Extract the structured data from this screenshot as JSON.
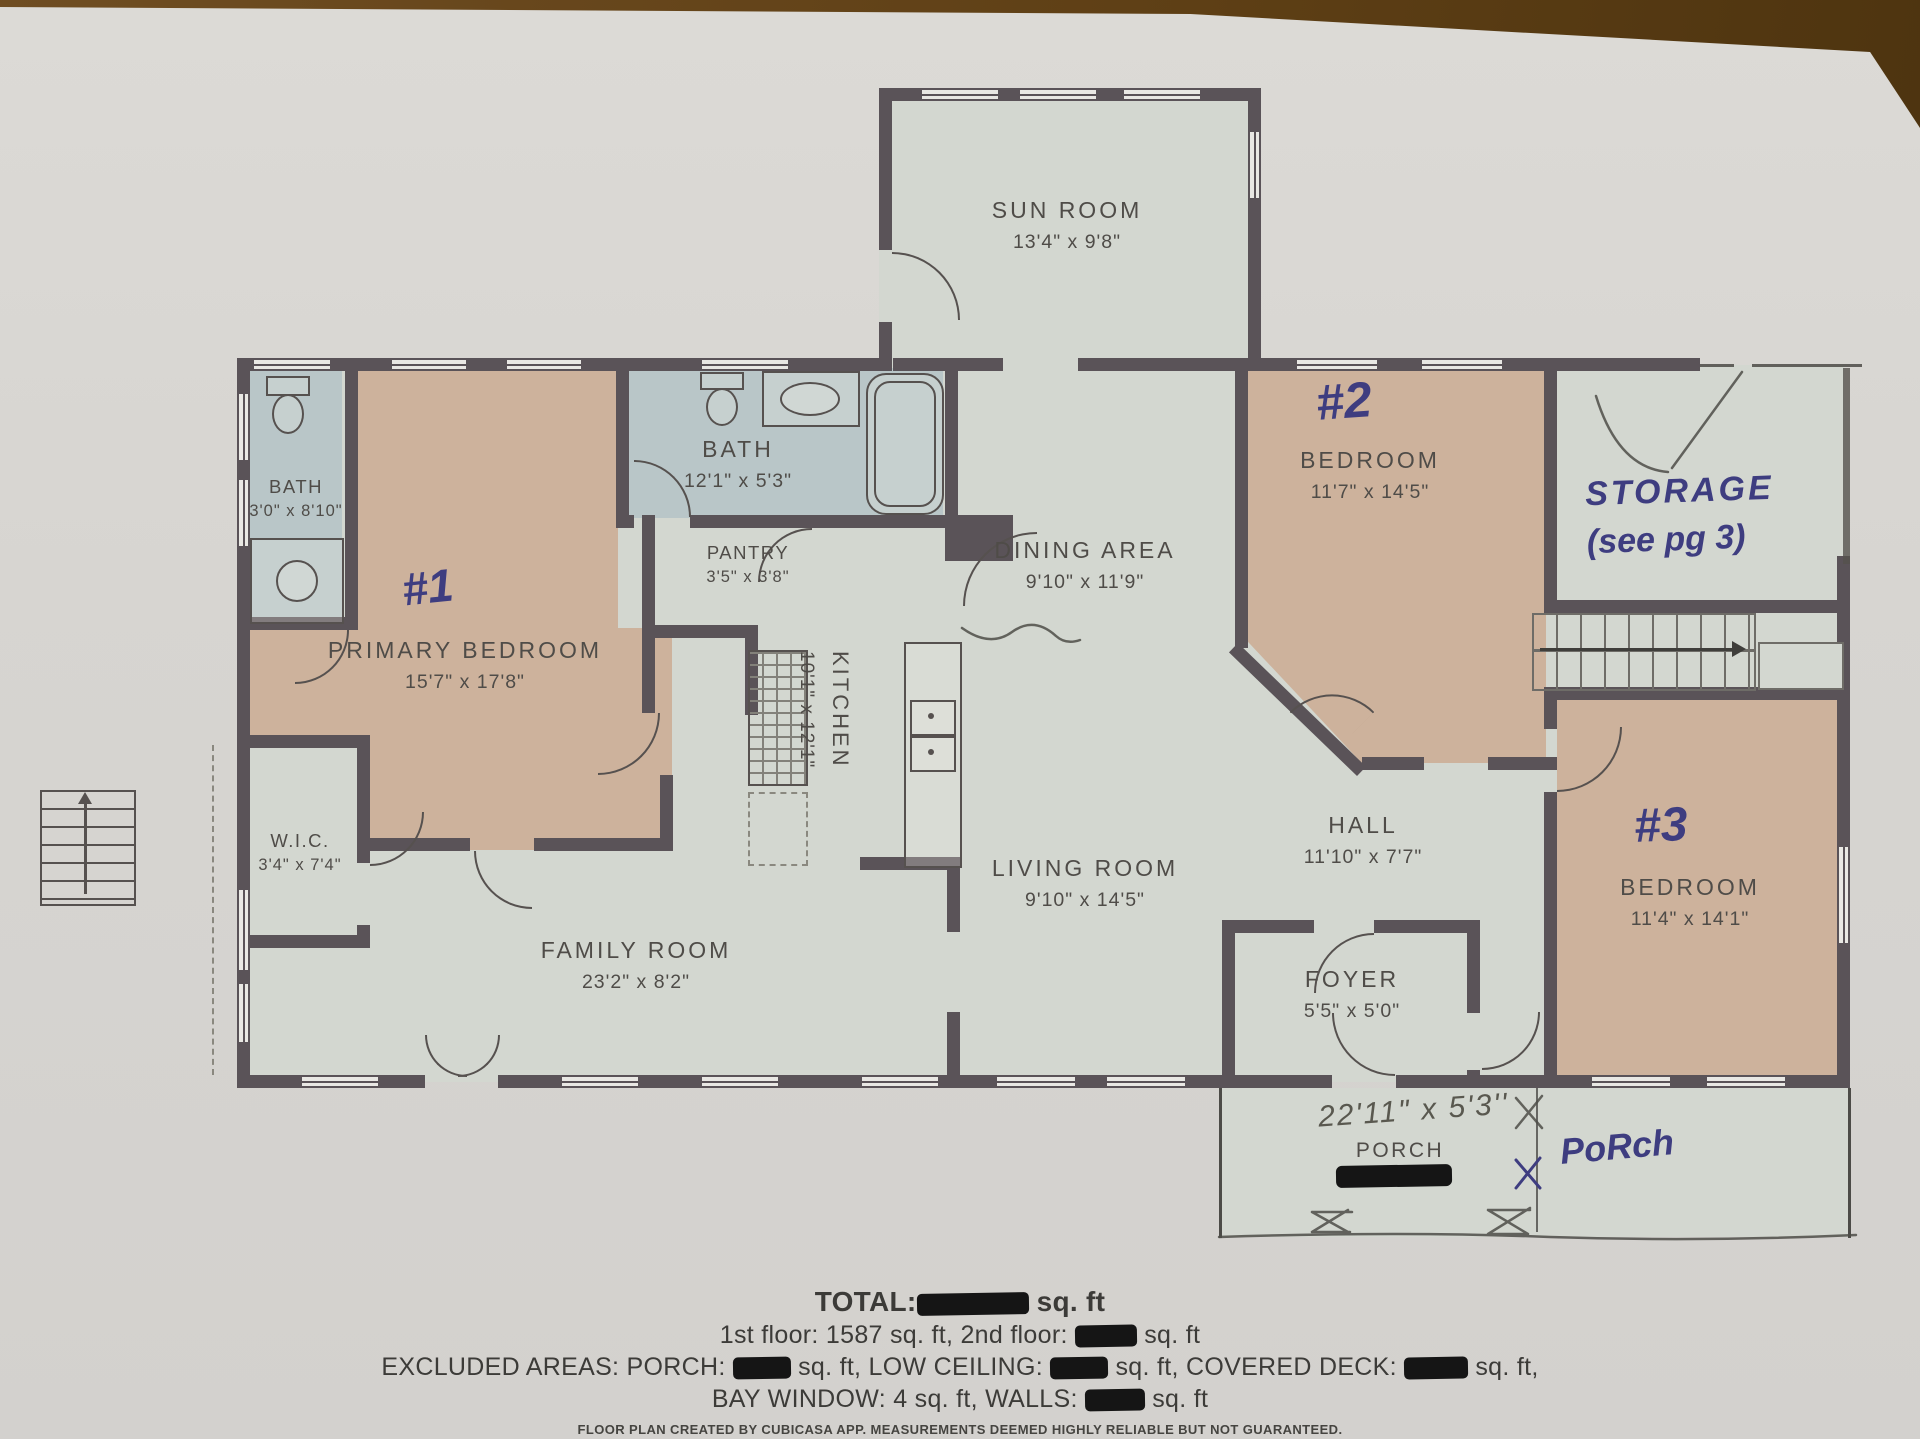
{
  "rooms": [
    {
      "id": "sun-room",
      "name": "SUN ROOM",
      "dims": "13'4\" x 9'8\""
    },
    {
      "id": "bath-upper",
      "name": "BATH",
      "dims": "12'1\" x 5'3\""
    },
    {
      "id": "bath-left",
      "name": "BATH",
      "dims": "3'0\" x 8'10\""
    },
    {
      "id": "pantry",
      "name": "PANTRY",
      "dims": "3'5\" x 3'8\""
    },
    {
      "id": "primary-bedroom",
      "name": "PRIMARY BEDROOM",
      "dims": "15'7\" x 17'8\"",
      "hand_number": "#1"
    },
    {
      "id": "kitchen",
      "name": "KITCHEN",
      "dims": "10'1\" x 12'1\""
    },
    {
      "id": "dining-area",
      "name": "DINING AREA",
      "dims": "9'10\" x 11'9\""
    },
    {
      "id": "bedroom-2",
      "name": "BEDROOM",
      "dims": "11'7\" x 14'5\"",
      "hand_number": "#2"
    },
    {
      "id": "wic",
      "name": "W.I.C.",
      "dims": "3'4\" x 7'4\""
    },
    {
      "id": "hall",
      "name": "HALL",
      "dims": "11'10\" x 7'7\""
    },
    {
      "id": "living-room",
      "name": "LIVING ROOM",
      "dims": "9'10\" x 14'5\""
    },
    {
      "id": "family-room",
      "name": "FAMILY ROOM",
      "dims": "23'2\" x 8'2\""
    },
    {
      "id": "bedroom-3",
      "name": "BEDROOM",
      "dims": "11'4\" x 14'1\"",
      "hand_number": "#3"
    },
    {
      "id": "foyer",
      "name": "FOYER",
      "dims": "5'5\" x 5'0\""
    },
    {
      "id": "porch",
      "name": "PORCH"
    }
  ],
  "handwritten": {
    "storage_line1": "STORAGE",
    "storage_line2": "(see pg 3)",
    "porch_label": "PoRch",
    "porch_dims": "22'11\" x 5'3''"
  },
  "summary": {
    "lines": [
      {
        "bold": true,
        "segments": [
          {
            "t": "TOTAL:"
          },
          {
            "redact": 112
          },
          {
            "t": " sq. ft"
          }
        ]
      },
      {
        "bold": false,
        "segments": [
          {
            "t": "1st floor: 1587 sq. ft, 2nd floor: "
          },
          {
            "redact": 62
          },
          {
            "t": " sq. ft"
          }
        ]
      },
      {
        "bold": false,
        "segments": [
          {
            "t": "EXCLUDED AREAS: PORCH: "
          },
          {
            "redact": 58
          },
          {
            "t": " sq. ft, LOW CEILING: "
          },
          {
            "redact": 58
          },
          {
            "t": " sq. ft, COVERED DECK: "
          },
          {
            "redact": 64
          },
          {
            "t": " sq. ft,"
          }
        ]
      },
      {
        "bold": false,
        "segments": [
          {
            "t": "BAY WINDOW: 4 sq. ft, WALLS: "
          },
          {
            "redact": 60
          },
          {
            "t": " sq. ft"
          }
        ]
      }
    ],
    "credit": "FLOOR PLAN CREATED BY CUBICASA APP. MEASUREMENTS DEEMED HIGHLY RELIABLE BUT NOT GUARANTEED."
  },
  "colors": {
    "wall": "#5a5358",
    "bedroom_fill": "#cdb29c",
    "bath_fill": "#b9c6c8",
    "room_fill": "#d3d7d0",
    "ink": "#3e3d80"
  }
}
